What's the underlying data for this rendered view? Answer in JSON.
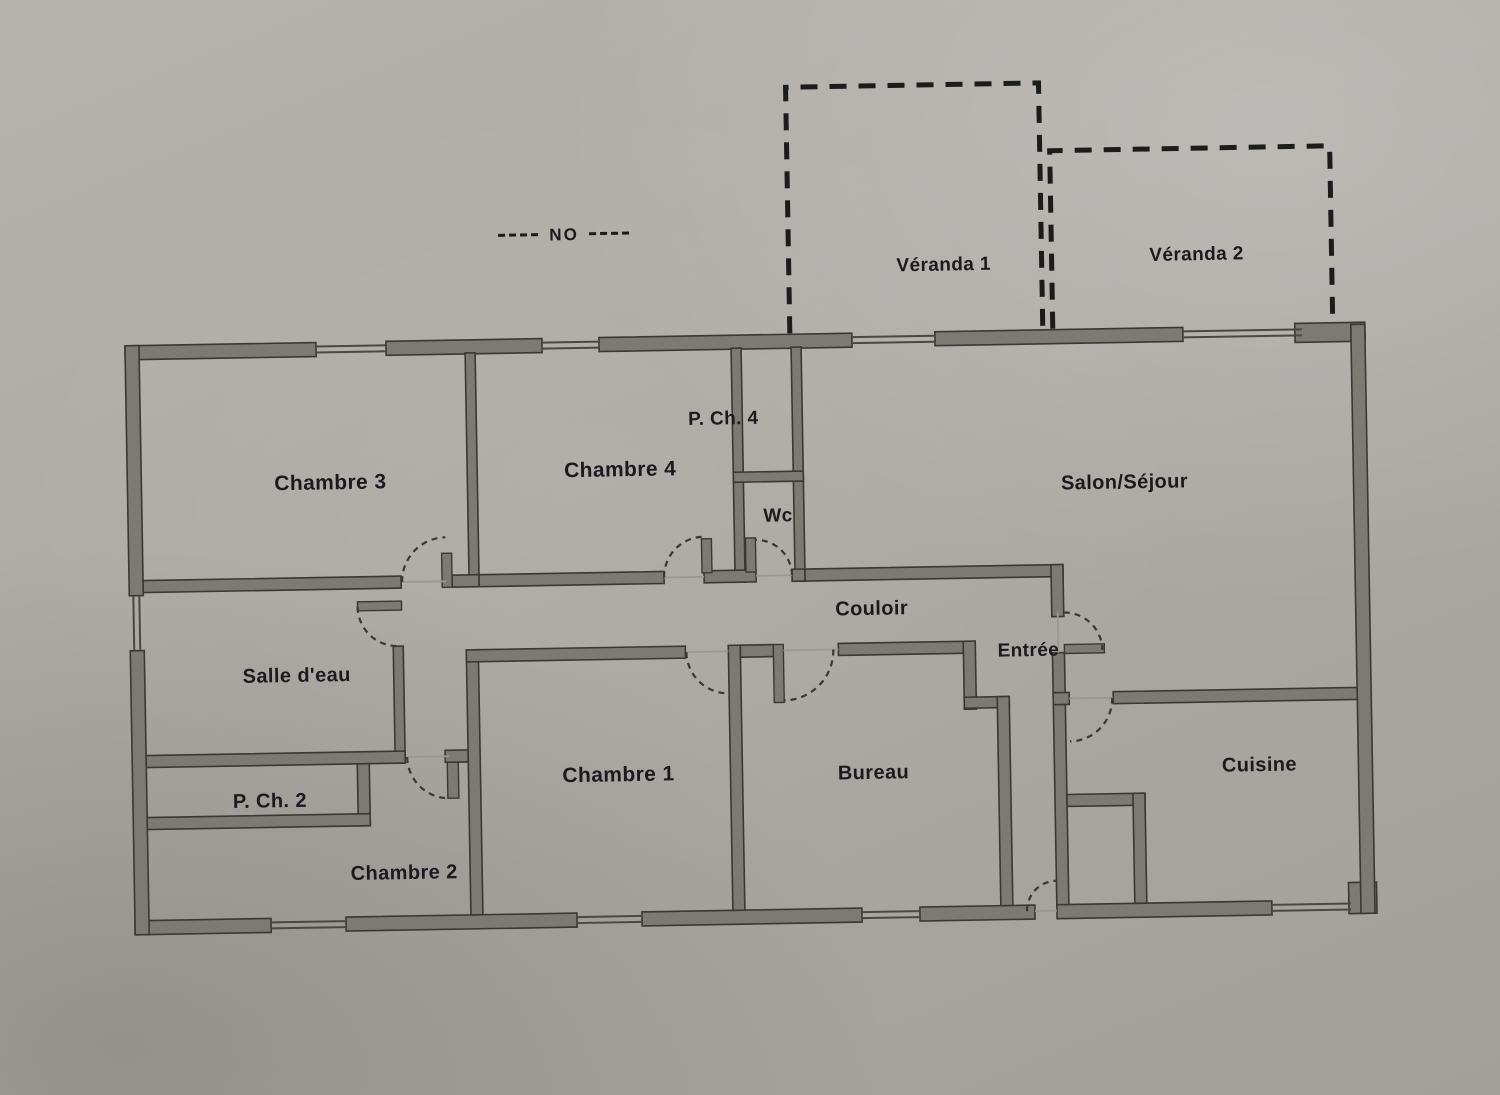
{
  "document": {
    "type": "floor-plan-photo"
  },
  "compass": {
    "label": "NO"
  },
  "verandas": {
    "v1": {
      "label": "Véranda 1"
    },
    "v2": {
      "label": "Véranda 2"
    }
  },
  "rooms": {
    "chambre3": {
      "label": "Chambre 3"
    },
    "chambre4": {
      "label": "Chambre 4"
    },
    "pch4": {
      "label": "P. Ch. 4"
    },
    "wc": {
      "label": "Wc"
    },
    "salon": {
      "label": "Salon/Séjour"
    },
    "couloir": {
      "label": "Couloir"
    },
    "entree": {
      "label": "Entrée"
    },
    "salle_eau": {
      "label": "Salle d'eau"
    },
    "pch2": {
      "label": "P. Ch. 2"
    },
    "chambre2": {
      "label": "Chambre 2"
    },
    "chambre1": {
      "label": "Chambre 1"
    },
    "bureau": {
      "label": "Bureau"
    },
    "cuisine": {
      "label": "Cuisine"
    }
  },
  "colors": {
    "paper": "#adaaa5",
    "wall_fill": "#7d7a74",
    "wall_outline": "#3a3834",
    "ink": "#1b1a1e",
    "veranda_dash": "#1c1c1c"
  }
}
